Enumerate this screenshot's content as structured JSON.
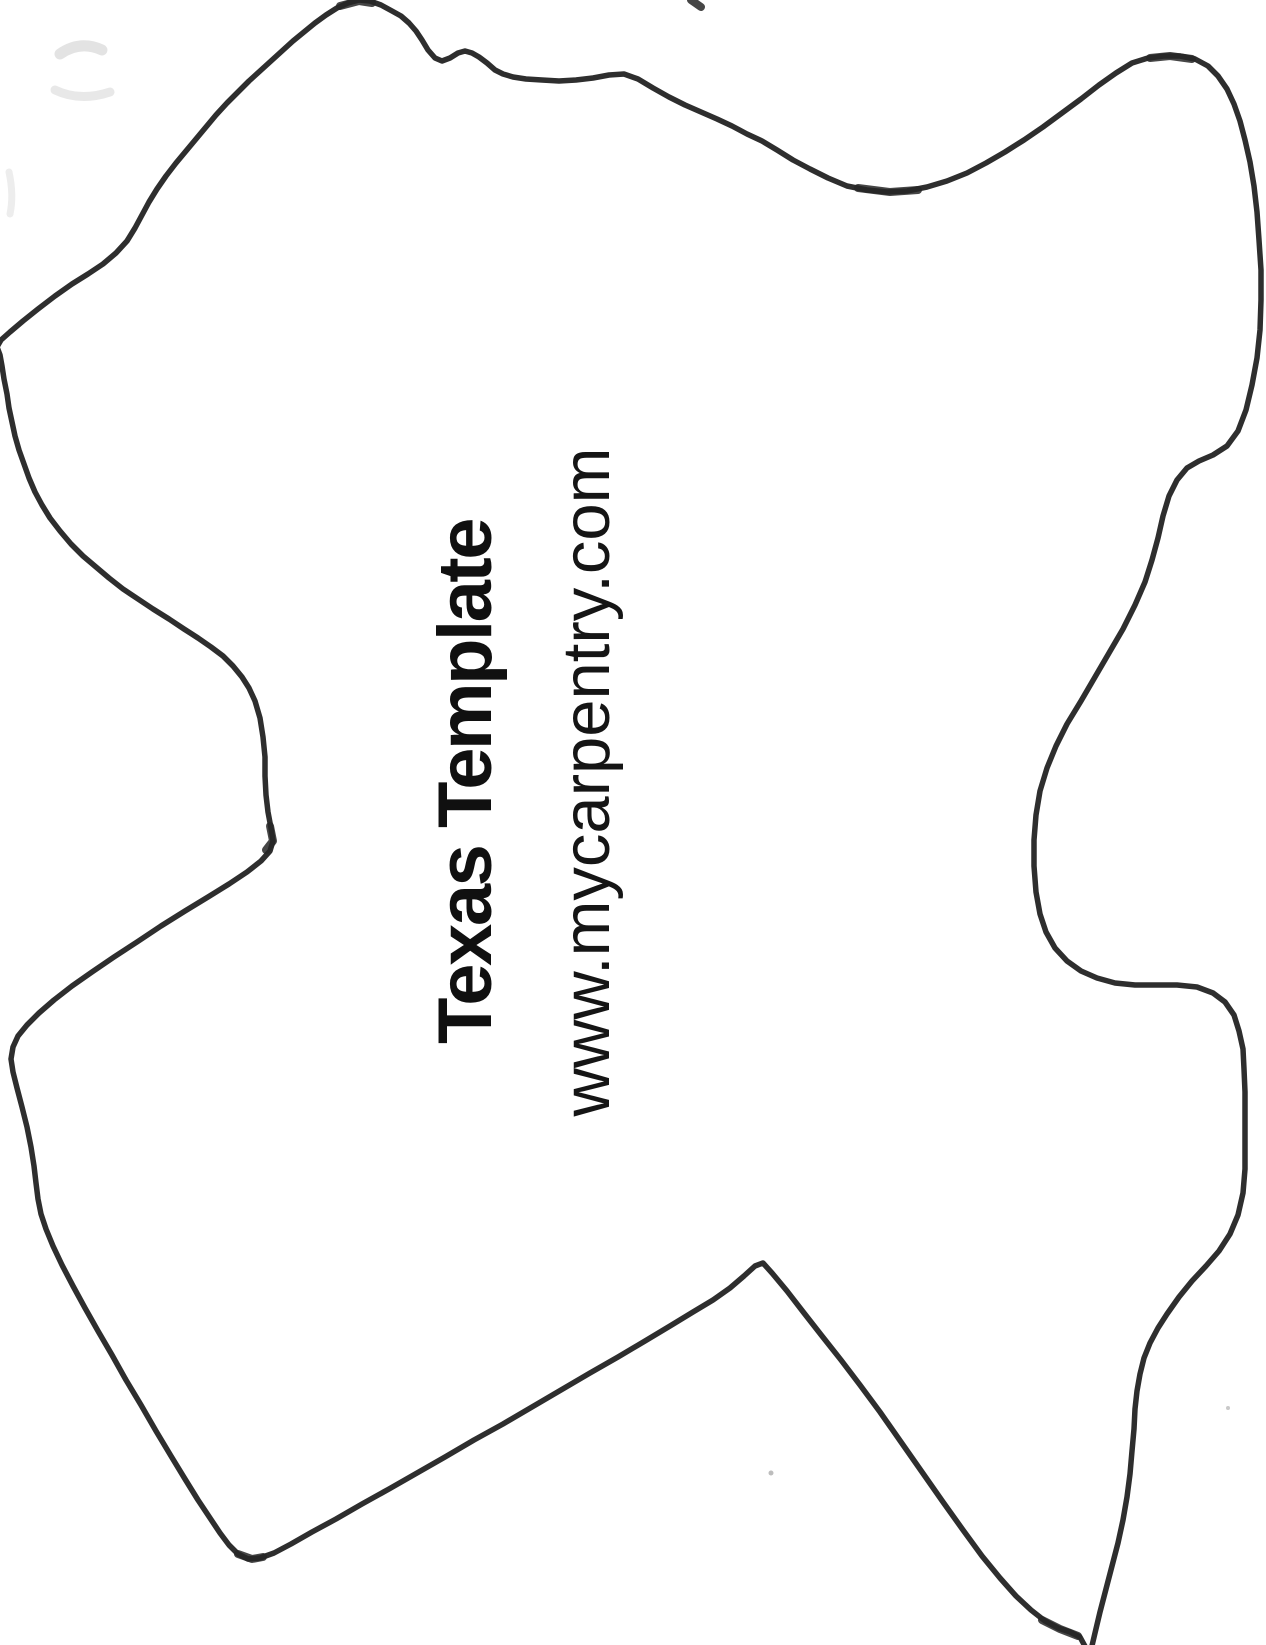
{
  "page": {
    "background_color": "#ffffff",
    "ink_color": "#2e2e2e"
  },
  "template": {
    "title": "Texas Template",
    "website": "www.mycarpentry.com"
  },
  "drawing": {
    "shape_name": "texas-state-outline-rotated",
    "stroke_width": "5.5",
    "outline_path": "M 1087 1650 L 1080 1637 L 1070 1632 L 1058 1628 L 1045 1621 L 1031 1610 L 1016 1596 L 1000 1578 L 982 1556 L 963 1530 L 943 1502 L 922 1472 L 901 1442 L 880 1412 L 860 1385 L 841 1360 L 822 1336 L 804 1313 L 787 1291 L 772 1273 L 763 1263 L 755 1266 L 744 1276 L 730 1288 L 713 1300 L 693 1312 L 670 1326 L 645 1341 L 618 1357 L 590 1373 L 561 1390 L 532 1407 L 503 1424 L 474 1440 L 445 1457 L 417 1473 L 389 1489 L 362 1504 L 336 1519 L 312 1532 L 291 1544 L 274 1553 L 260 1558 L 248 1559 L 238 1554 L 229 1545 L 220 1533 L 210 1518 L 198 1500 L 185 1479 L 171 1456 L 156 1431 L 141 1405 L 126 1380 L 112 1355 L 98 1331 L 85 1308 L 73 1286 L 62 1265 L 53 1246 L 46 1229 L 41 1214 L 38 1199 L 36 1183 L 34 1166 L 31 1147 L 27 1127 L 22 1107 L 17 1088 L 13 1072 L 11 1059 L 13 1047 L 18 1036 L 27 1025 L 39 1013 L 54 1000 L 72 986 L 92 972 L 114 957 L 137 942 L 161 926 L 185 911 L 208 897 L 229 884 L 247 872 L 261 861 L 270 851 L 273 841 L 271 828 L 268 812 L 266 795 L 265 776 L 265 757 L 263 737 L 260 718 L 255 701 L 249 688 L 242 677 L 233 666 L 223 656 L 211 647 L 198 638 L 184 629 L 169 619 L 153 609 L 138 599 L 123 589 L 109 578 L 96 567 L 83 556 L 71 544 L 60 531 L 50 518 L 42 505 L 35 492 L 29 478 L 24 464 L 19 450 L 15 436 L 12 422 L 9 408 L 7 394 L 4 379 L 2 366 L 0 355 L -3 347 L 1 340 L 10 332 L 23 321 L 38 309 L 55 296 L 72 284 L 88 274 L 103 264 L 116 253 L 127 241 L 135 228 L 142 215 L 149 202 L 157 189 L 166 176 L 176 163 L 186 151 L 196 139 L 206 127 L 216 115 L 227 103 L 238 92 L 249 81 L 260 71 L 271 61 L 282 51 L 293 41 L 304 32 L 315 23 L 326 15 L 337 8 L 348 3 L 359 0 L 370 1 L 381 5 L 392 11 L 401 16 L 409 23 L 416 31 L 422 40 L 428 50 L 435 58 L 442 61 L 450 58 L 458 53 L 465 51 L 472 53 L 479 57 L 487 63 L 495 70 L 503 74 L 513 77 L 526 79 L 542 80 L 559 81 L 576 80 L 593 78 L 609 75 L 624 74 L 638 79 L 653 88 L 669 97 L 685 105 L 701 112 L 717 119 L 732 126 L 747 134 L 762 141 L 777 150 L 793 160 L 810 169 L 828 178 L 847 186 L 867 190 L 887 192 L 907 191 L 927 187 L 947 181 L 967 173 L 986 163 L 1005 152 L 1024 140 L 1043 127 L 1062 113 L 1081 99 L 1099 85 L 1116 73 L 1132 63 L 1148 58 L 1164 56 L 1180 56 L 1195 59 L 1208 66 L 1218 76 L 1227 89 L 1234 104 L 1240 121 L 1245 140 L 1250 162 L 1254 186 L 1257 212 L 1259 240 L 1261 270 L 1261 300 L 1260 330 L 1257 358 L 1252 385 L 1246 410 L 1238 431 L 1227 446 L 1213 455 L 1199 461 L 1187 468 L 1177 480 L 1169 496 L 1163 516 L 1158 538 L 1152 560 L 1145 582 L 1135 605 L 1123 629 L 1109 653 L 1095 677 L 1081 701 L 1067 724 L 1056 746 L 1047 768 L 1040 791 L 1036 815 L 1034 840 L 1034 866 L 1036 892 L 1040 914 L 1046 932 L 1055 948 L 1067 961 L 1081 971 L 1097 978 L 1115 983 L 1135 985 L 1156 985 L 1177 985 L 1197 987 L 1213 993 L 1225 1002 L 1234 1015 L 1239 1031 L 1243 1049 L 1244 1069 L 1245 1092 L 1245 1118 L 1245 1144 L 1245 1169 L 1243 1193 L 1238 1215 L 1230 1234 L 1219 1251 L 1206 1266 L 1192 1281 L 1179 1297 L 1167 1314 L 1158 1328 L 1150 1343 L 1144 1358 L 1140 1374 L 1137 1391 L 1135 1409 L 1134 1429 L 1132 1451 L 1130 1474 L 1127 1497 L 1123 1520 L 1118 1543 L 1112 1566 L 1106 1589 L 1100 1612 L 1095 1633 L 1091 1650"
  }
}
